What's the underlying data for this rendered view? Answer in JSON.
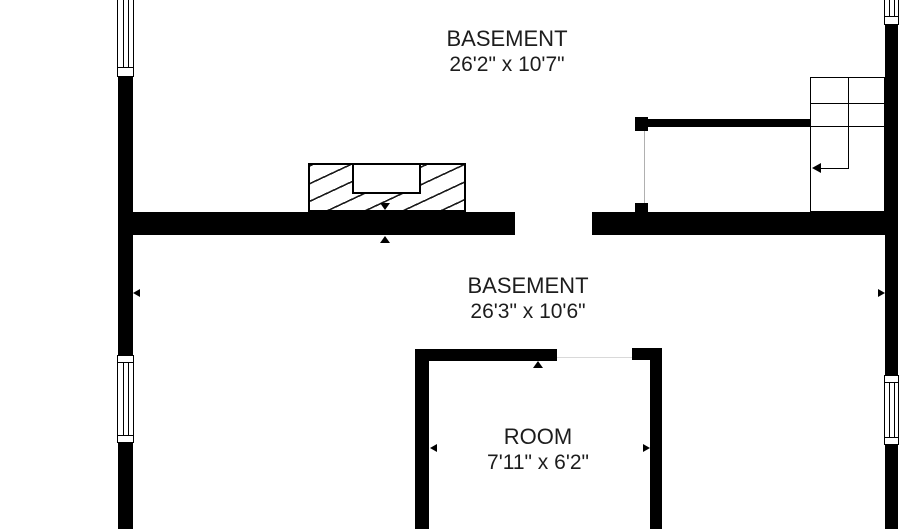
{
  "plan": {
    "title": "Basement floor plan",
    "rooms": [
      {
        "name": "BASEMENT",
        "dims": "26'2\" x 10'7\""
      },
      {
        "name": "BASEMENT",
        "dims": "26'3\" x 10'6\""
      },
      {
        "name": "ROOM",
        "dims": "7'11\" x 6'2\""
      }
    ],
    "colors": {
      "wall": "#000000",
      "text": "#1d1d1d",
      "background": "#ffffff"
    }
  }
}
